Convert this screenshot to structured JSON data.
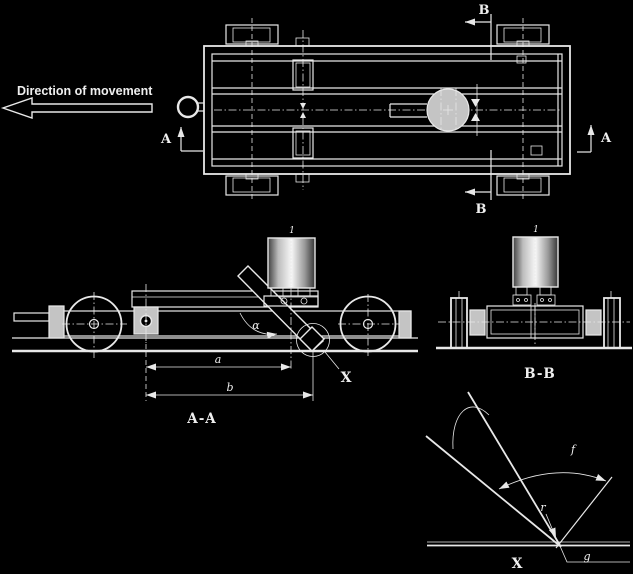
{
  "colors": {
    "background": "#000000",
    "line": "#e8e8e8",
    "fill_gray": "#c4c4c4"
  },
  "labels": {
    "direction": "Direction of movement",
    "section_a": "A",
    "section_b": "B",
    "view_aa": "A-A",
    "view_bb": "B-B",
    "detail_x": "X",
    "dim_a": "a",
    "dim_b": "b",
    "angle_alpha": "α",
    "detail_f": "f",
    "detail_r": "r",
    "detail_g": "g",
    "motor_callout": "1"
  }
}
